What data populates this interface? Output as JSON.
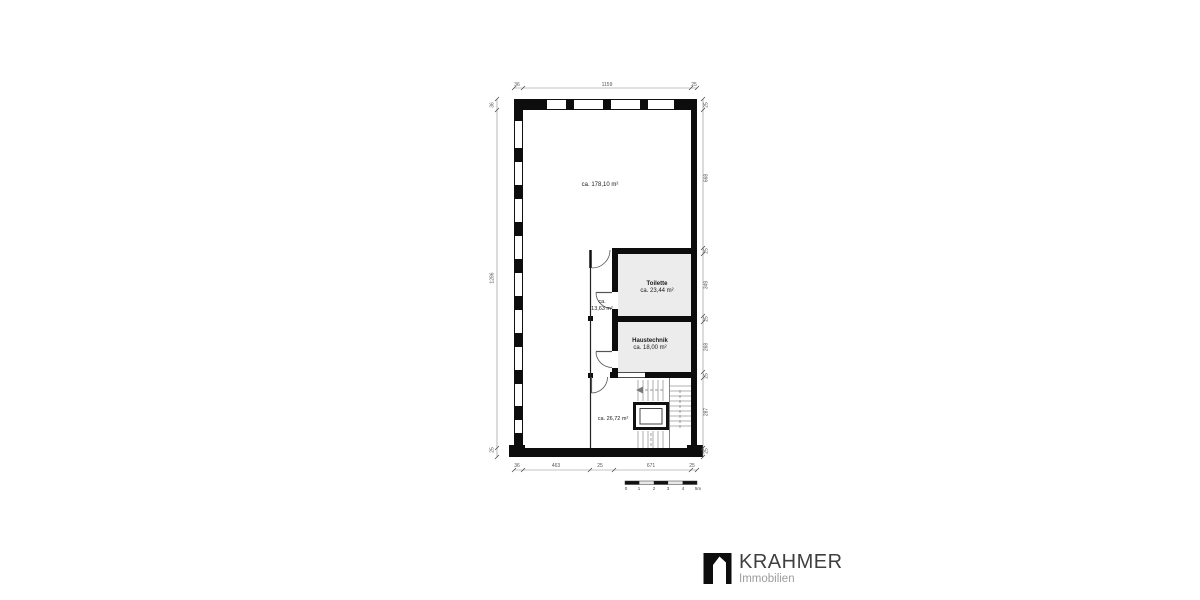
{
  "page": {
    "background": "#ffffff"
  },
  "floor_plan": {
    "rooms": {
      "main": {
        "area": "ca. 178,10 m²"
      },
      "toilette": {
        "name": "Toilette",
        "area": "ca. 23,44 m²"
      },
      "corridor": {
        "line1": "ca.",
        "line2": "13,63 m²"
      },
      "haustechnik": {
        "name": "Haustechnik",
        "area": "ca. 18,00 m²"
      },
      "stairwell": {
        "area": "ca. 26,72 m²"
      }
    },
    "dimensions": {
      "top": [
        "36",
        "1159",
        "25"
      ],
      "bottom": [
        "36",
        "463",
        "25",
        "671",
        "25"
      ],
      "left": [
        "36",
        "1286",
        "25"
      ],
      "right": [
        "25",
        "668",
        "25",
        "349",
        "25",
        "268",
        "25",
        "287",
        "25"
      ]
    },
    "scale_bar_ticks": [
      "0",
      "1",
      "2",
      "3",
      "4",
      "5m"
    ],
    "colors": {
      "wall": "#111111",
      "room_fill": "#ececec",
      "dimension": "#666666"
    }
  },
  "logo": {
    "brand": "KRAHMER",
    "subtitle": "Immobilien",
    "icon": "house-in-square",
    "brand_color": "#3f3f3f",
    "subtitle_color": "#9c9c9c"
  }
}
